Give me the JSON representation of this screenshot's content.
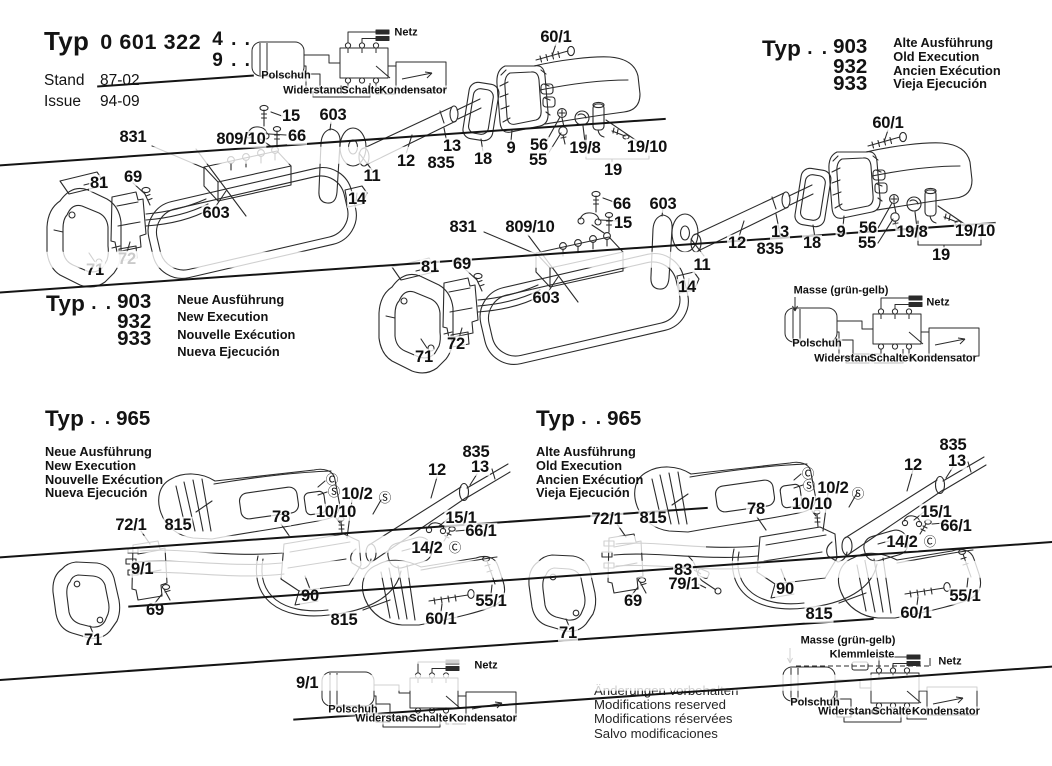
{
  "colors": {
    "ink": "#2b2b2b",
    "paper": "#ffffff"
  },
  "title_block": {
    "typ": "Typ",
    "number": "0 601 322",
    "suffix1": "4 . .",
    "suffix2": "9 . .",
    "stand_label": "Stand",
    "stand_value": "87-02",
    "issue_label": "Issue",
    "issue_value": "94-09"
  },
  "type_blocks": {
    "top_right": {
      "typ": "Typ",
      "dots": ". .",
      "models": [
        "903",
        "932",
        "933"
      ],
      "variants": [
        "Alte Ausführung",
        "Old Execution",
        "Ancien Exécution",
        "Vieja Ejecución"
      ]
    },
    "mid_left": {
      "typ": "Typ",
      "dots": ". .",
      "models": [
        "903",
        "932",
        "933"
      ],
      "variants": [
        "Neue Ausführung",
        "New Execution",
        "Nouvelle Exécution",
        "Nueva Ejecución"
      ]
    },
    "bottom_left": {
      "typ": "Typ",
      "dots": ". .",
      "models": [
        "965"
      ],
      "variants": [
        "Neue Ausführung",
        "New Execution",
        "Nouvelle Exécution",
        "Nueva Ejecución"
      ]
    },
    "bottom_mid": {
      "typ": "Typ",
      "dots": ". .",
      "models": [
        "965"
      ],
      "variants": [
        "Alte Ausführung",
        "Old Execution",
        "Ancien Exécution",
        "Vieja Ejecución"
      ]
    }
  },
  "footer_note": {
    "lines": [
      "Änderungen vorbehalten",
      "Modifications reserved",
      "Modifications réservées",
      "Salvo modificaciones"
    ]
  },
  "labels": [
    {
      "t": "831",
      "x": 133,
      "y": 137
    },
    {
      "t": "809/1",
      "x": 138,
      "y": 155,
      "strike": true
    },
    {
      "t": "809/10",
      "x": 241,
      "y": 139
    },
    {
      "t": "15",
      "x": 291,
      "y": 116
    },
    {
      "t": "66",
      "x": 297,
      "y": 136
    },
    {
      "t": "603",
      "x": 333,
      "y": 115
    },
    {
      "t": "603",
      "x": 216,
      "y": 213
    },
    {
      "t": "60/1",
      "x": 556,
      "y": 37
    },
    {
      "t": "12",
      "x": 406,
      "y": 161
    },
    {
      "t": "13",
      "x": 452,
      "y": 146
    },
    {
      "t": "835",
      "x": 441,
      "y": 163
    },
    {
      "t": "18",
      "x": 483,
      "y": 159
    },
    {
      "t": "9",
      "x": 511,
      "y": 148
    },
    {
      "t": "56",
      "x": 539,
      "y": 145
    },
    {
      "t": "55",
      "x": 538,
      "y": 160
    },
    {
      "t": "19/8",
      "x": 585,
      "y": 148
    },
    {
      "t": "19/10",
      "x": 647,
      "y": 147
    },
    {
      "t": "19",
      "x": 613,
      "y": 170
    },
    {
      "t": "11",
      "x": 372,
      "y": 176
    },
    {
      "t": "14",
      "x": 357,
      "y": 199
    },
    {
      "t": "81",
      "x": 99,
      "y": 183
    },
    {
      "t": "69",
      "x": 133,
      "y": 177
    },
    {
      "t": "71",
      "x": 95,
      "y": 270
    },
    {
      "t": "72",
      "x": 127,
      "y": 259
    },
    {
      "t": "60/1",
      "x": 888,
      "y": 123
    },
    {
      "t": "831",
      "x": 463,
      "y": 227
    },
    {
      "t": "809/1",
      "x": 468,
      "y": 243,
      "strike": true
    },
    {
      "t": "809/10",
      "x": 530,
      "y": 227
    },
    {
      "t": "66",
      "x": 622,
      "y": 204
    },
    {
      "t": "15",
      "x": 623,
      "y": 223
    },
    {
      "t": "603",
      "x": 663,
      "y": 204
    },
    {
      "t": "603",
      "x": 546,
      "y": 298
    },
    {
      "t": "12",
      "x": 737,
      "y": 243
    },
    {
      "t": "13",
      "x": 780,
      "y": 232
    },
    {
      "t": "835",
      "x": 770,
      "y": 249
    },
    {
      "t": "18",
      "x": 812,
      "y": 243
    },
    {
      "t": "9",
      "x": 841,
      "y": 232
    },
    {
      "t": "56",
      "x": 868,
      "y": 228
    },
    {
      "t": "55",
      "x": 867,
      "y": 243
    },
    {
      "t": "19/8",
      "x": 912,
      "y": 232
    },
    {
      "t": "19/10",
      "x": 975,
      "y": 231
    },
    {
      "t": "19",
      "x": 941,
      "y": 255
    },
    {
      "t": "11",
      "x": 702,
      "y": 265
    },
    {
      "t": "14",
      "x": 687,
      "y": 287
    },
    {
      "t": "81",
      "x": 430,
      "y": 267
    },
    {
      "t": "69",
      "x": 462,
      "y": 264
    },
    {
      "t": "71",
      "x": 424,
      "y": 357
    },
    {
      "t": "72",
      "x": 456,
      "y": 344
    },
    {
      "t": "72/1",
      "x": 131,
      "y": 525
    },
    {
      "t": "9/1",
      "x": 180,
      "y": 511,
      "strike": true
    },
    {
      "t": "815",
      "x": 178,
      "y": 525
    },
    {
      "t": "78",
      "x": 281,
      "y": 517
    },
    {
      "t": "10/10",
      "x": 336,
      "y": 512
    },
    {
      "t": "10/2",
      "x": 357,
      "y": 494
    },
    {
      "t": "Ⓒ",
      "x": 332,
      "y": 480,
      "k": "circ"
    },
    {
      "t": "Ⓢ",
      "x": 334,
      "y": 492,
      "k": "circ"
    },
    {
      "t": "Ⓢ",
      "x": 385,
      "y": 498,
      "k": "circ"
    },
    {
      "t": "12",
      "x": 437,
      "y": 470
    },
    {
      "t": "835",
      "x": 476,
      "y": 452
    },
    {
      "t": "13",
      "x": 480,
      "y": 467
    },
    {
      "t": "15/1",
      "x": 461,
      "y": 518
    },
    {
      "t": "66/1",
      "x": 481,
      "y": 531
    },
    {
      "t": "14/2",
      "x": 427,
      "y": 548
    },
    {
      "t": "Ⓒ",
      "x": 455,
      "y": 548,
      "k": "circ"
    },
    {
      "t": "90",
      "x": 310,
      "y": 596
    },
    {
      "t": "9/1",
      "x": 346,
      "y": 606,
      "strike": true
    },
    {
      "t": "815",
      "x": 344,
      "y": 620
    },
    {
      "t": "60/1",
      "x": 441,
      "y": 619
    },
    {
      "t": "55/1",
      "x": 491,
      "y": 601
    },
    {
      "t": "69",
      "x": 155,
      "y": 610
    },
    {
      "t": "71",
      "x": 93,
      "y": 640
    },
    {
      "t": "72/1",
      "x": 607,
      "y": 519
    },
    {
      "t": "9/1",
      "x": 656,
      "y": 503,
      "strike": true
    },
    {
      "t": "815",
      "x": 653,
      "y": 518
    },
    {
      "t": "78",
      "x": 756,
      "y": 509
    },
    {
      "t": "10/10",
      "x": 812,
      "y": 504
    },
    {
      "t": "10/2",
      "x": 833,
      "y": 488
    },
    {
      "t": "Ⓒ",
      "x": 808,
      "y": 474,
      "k": "circ"
    },
    {
      "t": "Ⓢ",
      "x": 809,
      "y": 486,
      "k": "circ"
    },
    {
      "t": "Ⓢ",
      "x": 858,
      "y": 494,
      "k": "circ"
    },
    {
      "t": "12",
      "x": 913,
      "y": 465
    },
    {
      "t": "835",
      "x": 953,
      "y": 445
    },
    {
      "t": "13",
      "x": 957,
      "y": 461
    },
    {
      "t": "15/1",
      "x": 936,
      "y": 512
    },
    {
      "t": "66/1",
      "x": 956,
      "y": 526
    },
    {
      "t": "14/2",
      "x": 902,
      "y": 542
    },
    {
      "t": "Ⓒ",
      "x": 930,
      "y": 542,
      "k": "circ"
    },
    {
      "t": "83",
      "x": 683,
      "y": 570
    },
    {
      "t": "79/1",
      "x": 684,
      "y": 584
    },
    {
      "t": "90",
      "x": 785,
      "y": 589
    },
    {
      "t": "9/1",
      "x": 821,
      "y": 600,
      "strike": true
    },
    {
      "t": "815",
      "x": 819,
      "y": 614
    },
    {
      "t": "60/1",
      "x": 916,
      "y": 613
    },
    {
      "t": "55/1",
      "x": 965,
      "y": 596
    },
    {
      "t": "69",
      "x": 633,
      "y": 601
    },
    {
      "t": "71",
      "x": 568,
      "y": 633
    },
    {
      "t": "Netz",
      "x": 406,
      "y": 33,
      "k": "wire"
    },
    {
      "t": "Polschuh",
      "x": 286,
      "y": 76,
      "k": "wire"
    },
    {
      "t": "Widerstand",
      "x": 313,
      "y": 91,
      "k": "wire"
    },
    {
      "t": "Schalter",
      "x": 363,
      "y": 91,
      "k": "wire"
    },
    {
      "t": "Kondensator",
      "x": 413,
      "y": 91,
      "k": "wire"
    },
    {
      "t": "Masse (grün-gelb)",
      "x": 841,
      "y": 291,
      "k": "wire"
    },
    {
      "t": "Netz",
      "x": 938,
      "y": 303,
      "k": "wire"
    },
    {
      "t": "Polschuh",
      "x": 817,
      "y": 344,
      "k": "wire"
    },
    {
      "t": "Widerstand",
      "x": 844,
      "y": 359,
      "k": "wire"
    },
    {
      "t": "Schalter",
      "x": 891,
      "y": 359,
      "k": "wire"
    },
    {
      "t": "Kondensator",
      "x": 943,
      "y": 359,
      "k": "wire"
    },
    {
      "t": "Netz",
      "x": 486,
      "y": 666,
      "k": "wire"
    },
    {
      "t": "Polschuh",
      "x": 353,
      "y": 710,
      "k": "wire"
    },
    {
      "t": "Widerstand",
      "x": 385,
      "y": 719,
      "k": "wire"
    },
    {
      "t": "Schalter",
      "x": 431,
      "y": 719,
      "k": "wire"
    },
    {
      "t": "Kondensator",
      "x": 483,
      "y": 719,
      "k": "wire"
    },
    {
      "t": "Masse (grün-gelb)",
      "x": 848,
      "y": 641,
      "k": "wire"
    },
    {
      "t": "Klemmleiste",
      "x": 862,
      "y": 655,
      "k": "wire"
    },
    {
      "t": "Netz",
      "x": 950,
      "y": 662,
      "k": "wire"
    },
    {
      "t": "Polschuh",
      "x": 815,
      "y": 703,
      "k": "wire"
    },
    {
      "t": "Widerstand",
      "x": 848,
      "y": 712,
      "k": "wire"
    },
    {
      "t": "Schalter",
      "x": 894,
      "y": 712,
      "k": "wire"
    },
    {
      "t": "Kondensator",
      "x": 946,
      "y": 712,
      "k": "wire"
    }
  ]
}
